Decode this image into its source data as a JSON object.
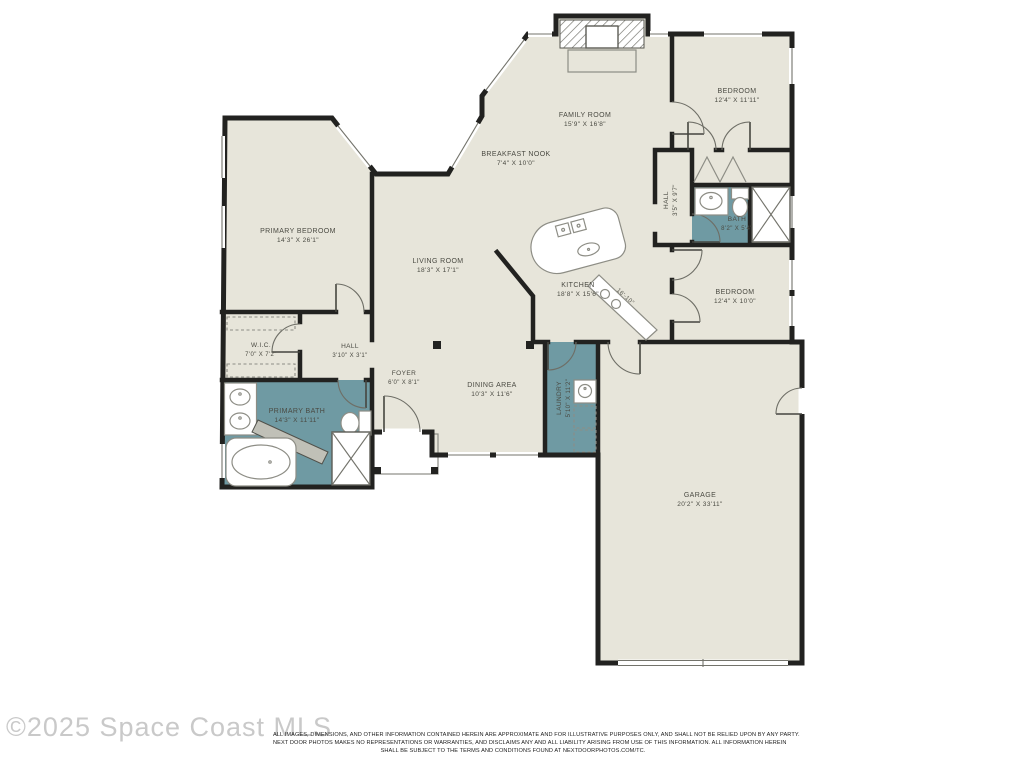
{
  "watermark": "©2025 Space Coast MLS",
  "colors": {
    "floor": "#e7e5da",
    "wet_room": "#6f9aa3",
    "wall": "#222220"
  },
  "rooms": {
    "family_room": {
      "name": "FAMILY ROOM",
      "dims": "15'9\" X 16'8\""
    },
    "bedroom_top": {
      "name": "BEDROOM",
      "dims": "12'4\" X 11'11\""
    },
    "breakfast_nook": {
      "name": "BREAKFAST NOOK",
      "dims": "7'4\" X 10'0\""
    },
    "hall_right": {
      "name": "HALL",
      "dims": "3'5\" X 9'7\""
    },
    "bath": {
      "name": "BATH",
      "dims": "8'2\" X 5'4\""
    },
    "primary_bedroom": {
      "name": "PRIMARY BEDROOM",
      "dims": "14'3\" X 26'1\""
    },
    "living_room": {
      "name": "LIVING ROOM",
      "dims": "18'3\" X 17'1\""
    },
    "kitchen": {
      "name": "KITCHEN",
      "dims": "18'8\" X 15'6\""
    },
    "bedroom_bottom": {
      "name": "BEDROOM",
      "dims": "12'4\" X 10'0\""
    },
    "wic": {
      "name": "W.I.C.",
      "dims": "7'0\" X 7'2\""
    },
    "hall_left": {
      "name": "HALL",
      "dims": "3'10\" X 3'1\""
    },
    "foyer": {
      "name": "FOYER",
      "dims": "6'0\" X 8'1\""
    },
    "dining_area": {
      "name": "DINING AREA",
      "dims": "10'3\" X 11'6\""
    },
    "laundry": {
      "name": "LAUNDRY",
      "dims": "5'10\" X 11'2\""
    },
    "primary_bath": {
      "name": "PRIMARY BATH",
      "dims": "14'3\" X 11'11\""
    },
    "garage": {
      "name": "GARAGE",
      "dims": "20'2\" X 33'11\""
    }
  },
  "annotations": {
    "counter_dim": "16'-10\""
  },
  "disclaimer": {
    "line1": "ALL IMAGES, DIMENSIONS, AND OTHER INFORMATION CONTAINED HEREIN ARE APPROXIMATE AND FOR ILLUSTRATIVE PURPOSES ONLY, AND SHALL NOT BE RELIED UPON BY ANY PARTY.",
    "line2": "NEXT DOOR PHOTOS MAKES NO REPRESENTATIONS OR WARRANTIES, AND DISCLAIMS ANY AND ALL LIABILITY ARISING FROM USE OF THIS INFORMATION. ALL INFORMATION HEREIN",
    "line3": "SHALL BE SUBJECT TO THE TERMS AND CONDITIONS FOUND AT NEXTDOORPHOTOS.COM/TC."
  }
}
